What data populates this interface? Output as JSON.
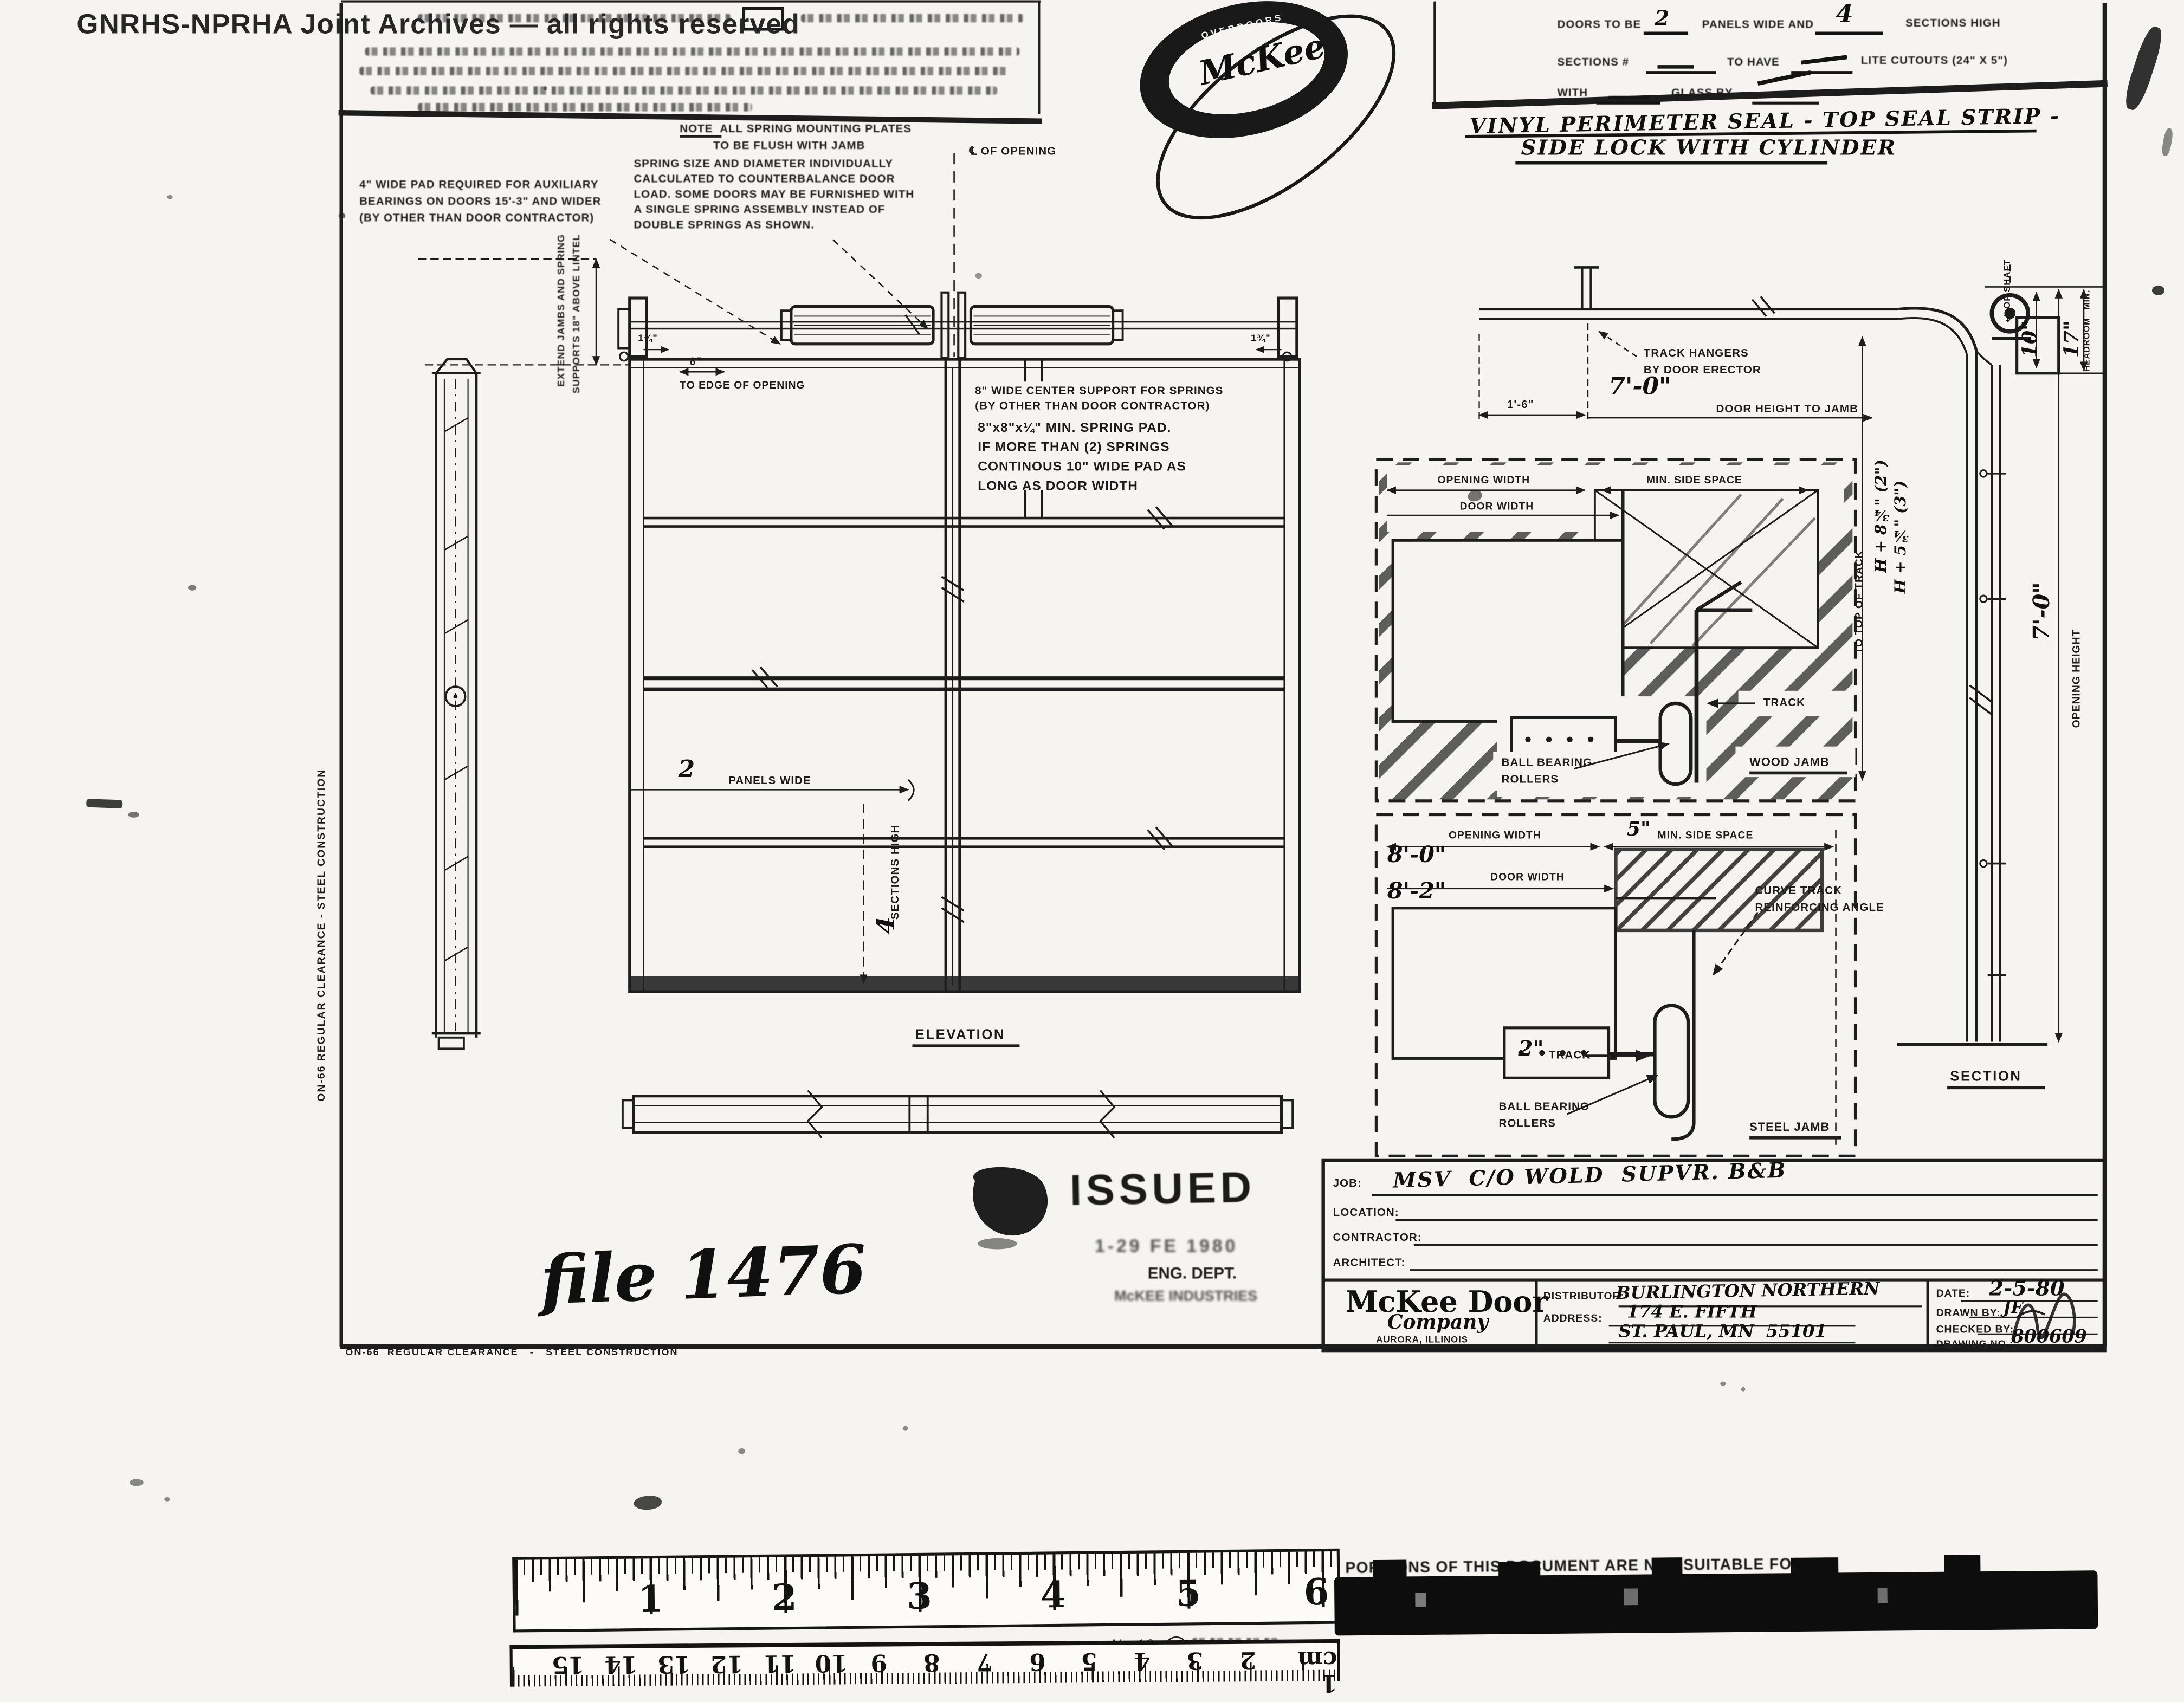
{
  "watermark": "GNRHS-NPRHA Joint Archives — all rights reserved",
  "logo": {
    "top": "OVERDOORS",
    "name": "McKee",
    "bottom": "OPERATORS"
  },
  "spec_box": {
    "doors_pre": "DOORS TO BE",
    "panels_val": "2",
    "panels_mid": "PANELS WIDE AND",
    "sections_val": "4",
    "sections_post": "SECTIONS HIGH",
    "sections_pre": "SECTIONS #",
    "to_have": "TO HAVE",
    "lite": "LITE CUTOUTS (24\" X 5\")",
    "with": "WITH",
    "glass_by": "GLASS BY",
    "hand_line1": "VINYL PERIMETER SEAL - TOP SEAL STRIP -",
    "hand_line2": "SIDE LOCK WITH CYLINDER"
  },
  "notes": {
    "flush": [
      "NOTE  ALL SPRING MOUNTING PLATES",
      "TO BE FLUSH WITH JAMB"
    ],
    "pad": [
      "4\" WIDE PAD REQUIRED FOR AUXILIARY",
      "BEARINGS ON DOORS 15'-3\" AND WIDER",
      "(BY OTHER THAN DOOR CONTRACTOR)"
    ],
    "spring": [
      "SPRING SIZE AND DIAMETER INDIVIDUALLY",
      "CALCULATED TO COUNTERBALANCE DOOR",
      "LOAD. SOME DOORS MAY BE FURNISHED WITH",
      "A SINGLE SPRING ASSEMBLY INSTEAD OF",
      "DOUBLE SPRINGS AS SHOWN."
    ],
    "center": [
      "8\" WIDE CENTER SUPPORT FOR SPRINGS",
      "(BY OTHER THAN DOOR CONTRACTOR)"
    ],
    "center_hand": [
      "8\"x8\"x¼\" MIN. SPRING PAD.",
      "IF MORE THAN (2) SPRINGS",
      "CONTINOUS 10\" WIDE PAD AS",
      "LONG AS DOOR WIDTH"
    ],
    "extend": [
      "EXTEND JAMBS AND SPRING",
      "SUPPORTS 18\" ABOVE LINTEL"
    ]
  },
  "elevation": {
    "centerline": "℄ OF OPENING",
    "edge_dim": "8\"",
    "edge_label": "TO EDGE OF OPENING",
    "tick_left": "1¾\"",
    "tick_right": "1¾\"",
    "panels_val": "2",
    "panels_label": "PANELS WIDE",
    "sections_val": "4",
    "sections_label": "SECTIONS HIGH",
    "title": "ELEVATION"
  },
  "track": {
    "hangers": [
      "TRACK HANGERS",
      "BY DOOR ERECTOR"
    ],
    "dim_jamb": "1'-6\"",
    "door_height_val": "7'-0\"",
    "door_height_label": "DOOR HEIGHT TO JAMB",
    "shaft_val": "10\"",
    "shaft_label": "℄ OF SHAFT",
    "headroom_val": "17\"",
    "headroom_min": "MIN.",
    "headroom_label": "HEADROOM"
  },
  "wood_jamb": {
    "opening": "OPENING WIDTH",
    "door": "DOOR WIDTH",
    "side": "MIN. SIDE SPACE",
    "track": "TRACK",
    "rollers": [
      "BALL BEARING",
      "ROLLERS"
    ],
    "title": "WOOD JAMB",
    "top_of_track": "TO TOP OF TRACK",
    "hand_2in": "H + 8¾\" (2\")",
    "hand_3in": "H + 5¾\" (3\")"
  },
  "steel_jamb": {
    "opening": "OPENING WIDTH",
    "opening_val": "8'-0\"",
    "side_val": "5\"",
    "side": "MIN. SIDE SPACE",
    "door": "DOOR WIDTH",
    "door_val": "8'-2\"",
    "curve": [
      "CURVE TRACK",
      "REINFORCING ANGLE"
    ],
    "track_val": "2\"",
    "track": "TRACK",
    "rollers": [
      "BALL BEARING",
      "ROLLERS"
    ],
    "title": "STEEL JAMB"
  },
  "section": {
    "height_val": "7'-0\"",
    "height_label": "OPENING HEIGHT",
    "title": "SECTION"
  },
  "title_block": {
    "job": "JOB:",
    "job_val": "MSV  C/O WOLD  SUPVR. B&B",
    "location": "LOCATION:",
    "contractor": "CONTRACTOR:",
    "architect": "ARCHITECT:",
    "company": [
      "McKee Door",
      "Company",
      "AURORA, ILLINOIS"
    ],
    "distributor": "DISTRIBUTOR:",
    "distributor_val": "BURLINGTON NORTHERN",
    "address": "ADDRESS:",
    "address_val1": "174 E. FIFTH",
    "address_val2": "ST. PAUL, MN  55101",
    "date": "DATE:",
    "date_val": "2-5-80",
    "drawn": "DRAWN BY:",
    "drawn_val": "JF",
    "checked": "CHECKED BY:",
    "drawing_no": "DRAWING NO.:",
    "drawing_no_val": "800609"
  },
  "stamp": {
    "issued": "ISSUED",
    "date": "1-29 FE 1980",
    "dept": "ENG. DEPT.",
    "org": "McKEE INDUSTRIES"
  },
  "file_note": "file 1476",
  "margin": {
    "left": "ON-66 REGULAR CLEARANCE - STEEL CONSTRUCTION",
    "bottom": "ON-66  REGULAR CLEARANCE   -   STEEL CONSTRUCTION"
  },
  "ruler": {
    "inches": [
      "1",
      "2",
      "3",
      "4",
      "5",
      "6"
    ],
    "model": "No.18",
    "cm": [
      "15",
      "14",
      "13",
      "12",
      "11",
      "10",
      "9",
      "8",
      "7",
      "6",
      "5",
      "4",
      "3",
      "2",
      "1 cm"
    ]
  },
  "redaction": {
    "line1": "PORTIONS OF THIS DOCUMENT ARE NOT SUITABLE FOR RE-"
  }
}
